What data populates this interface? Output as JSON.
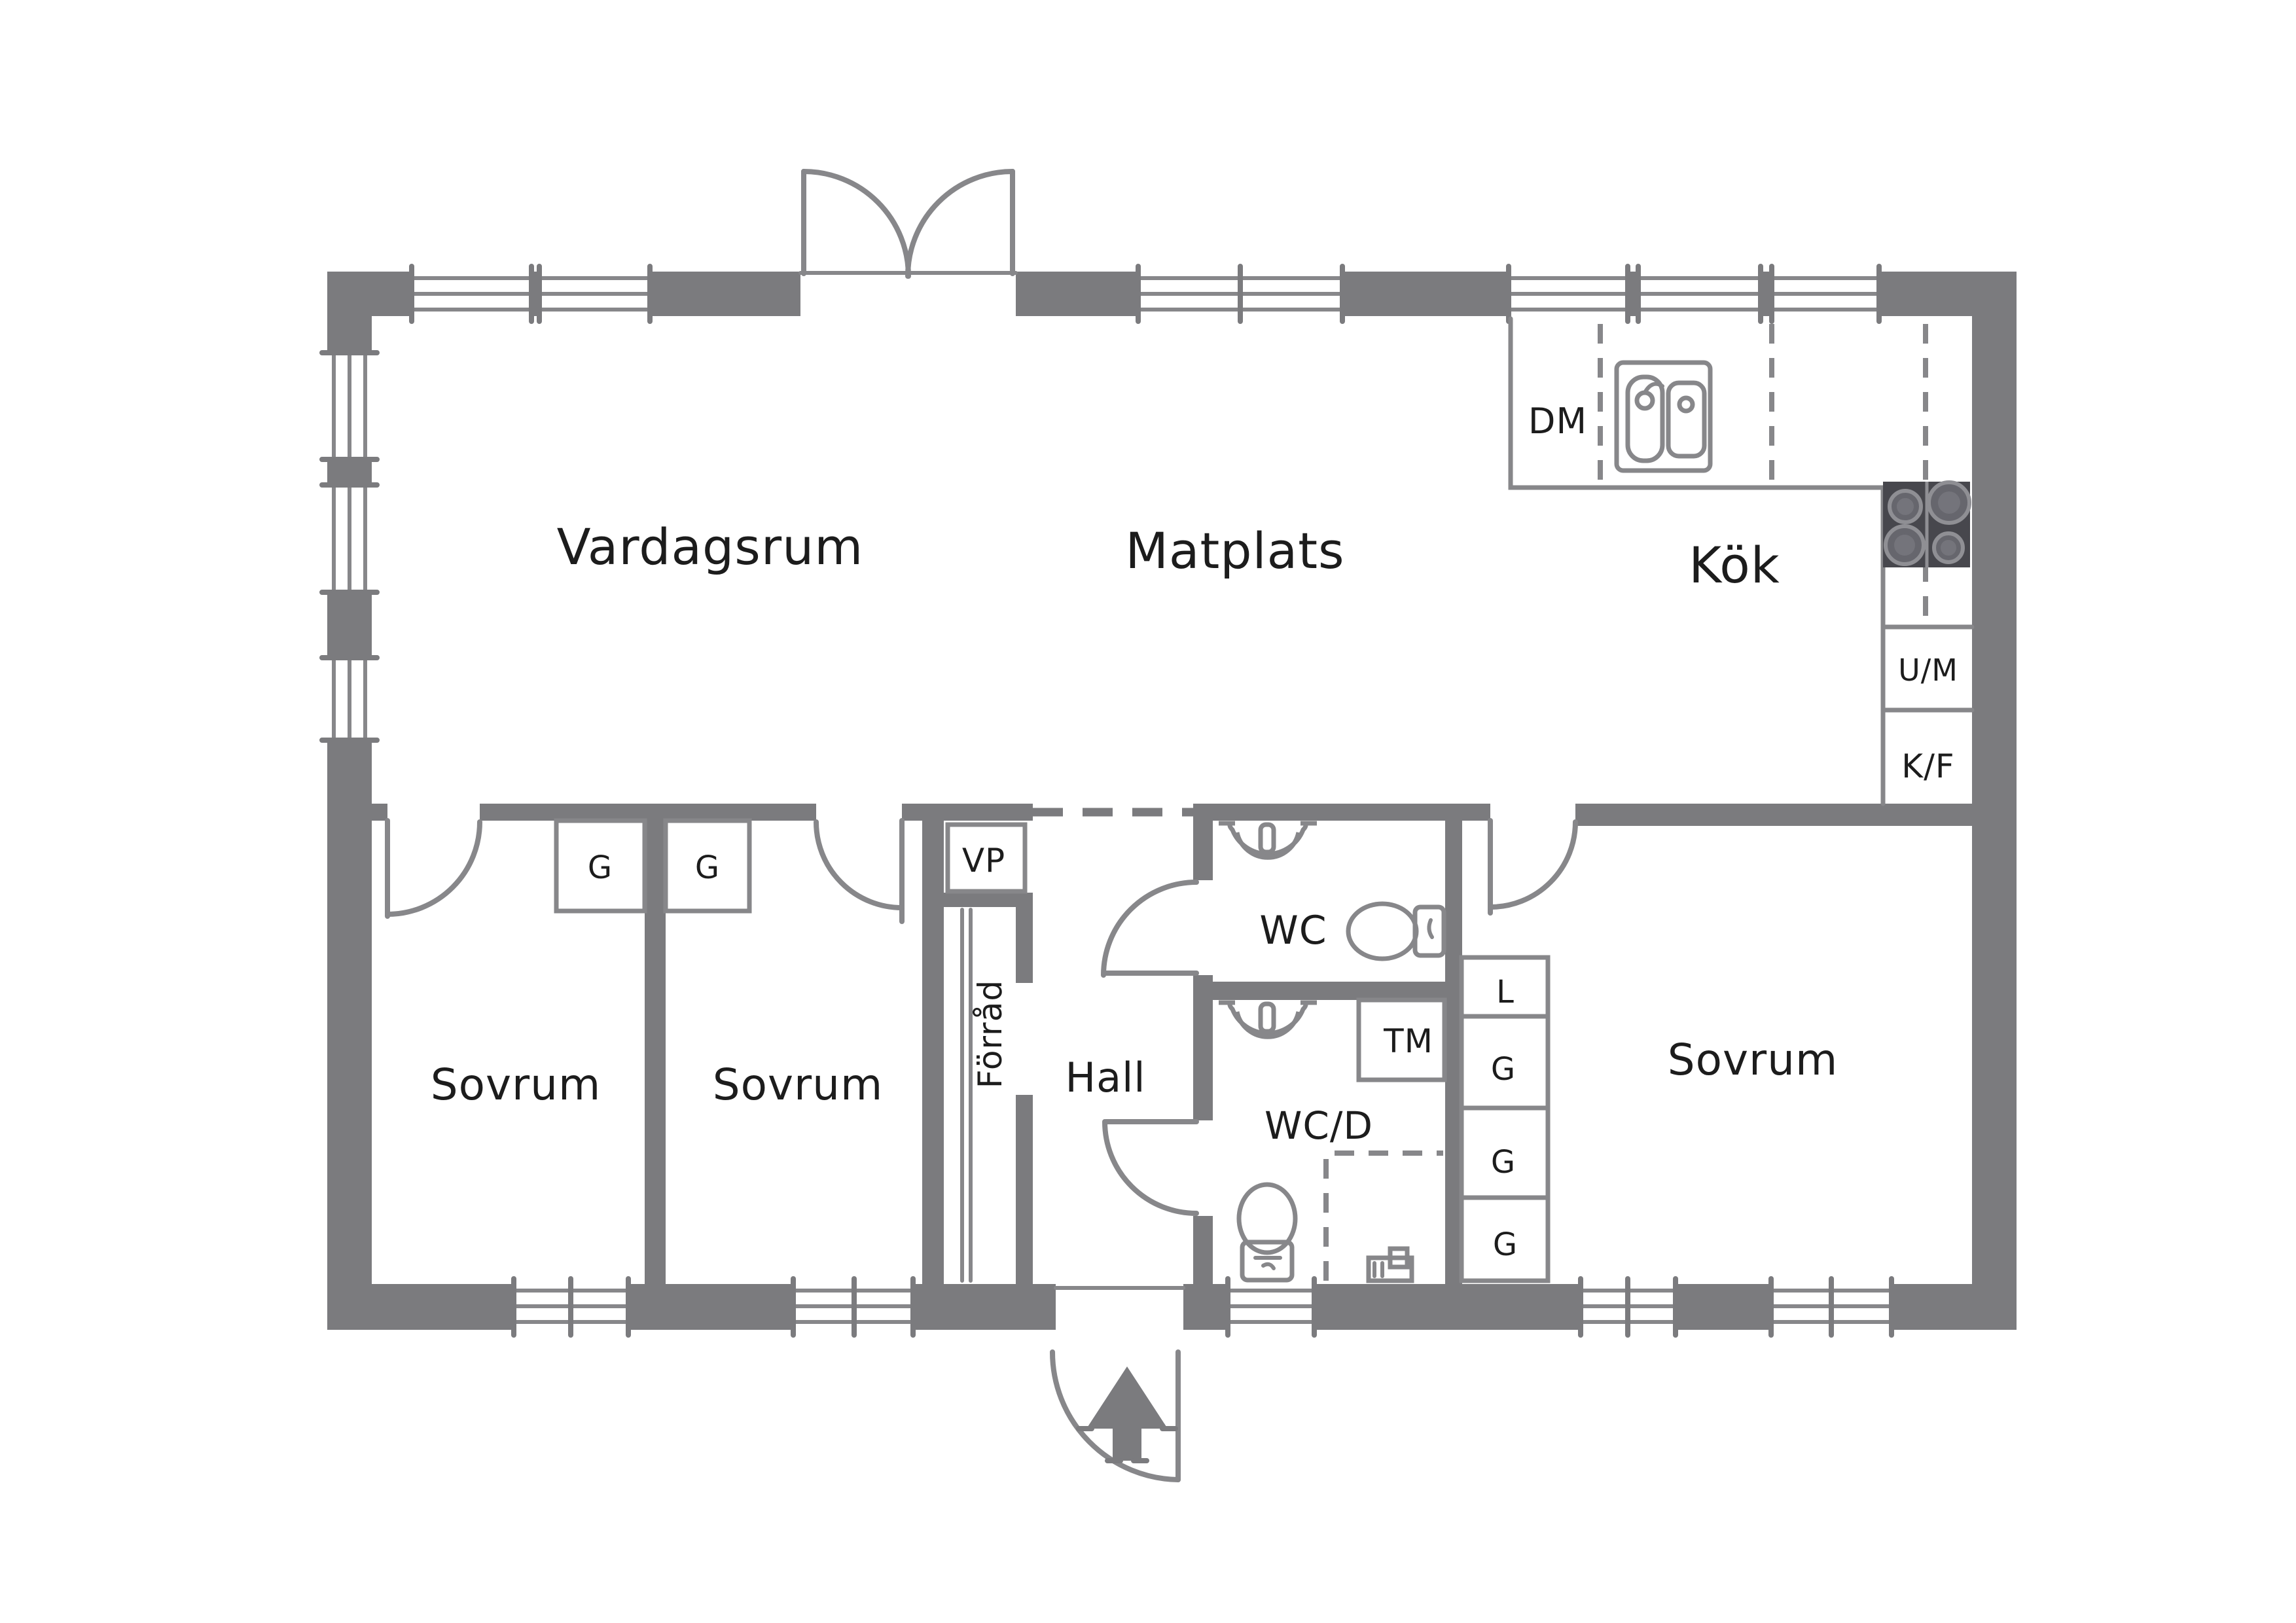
{
  "title": "Floor plan sketch (Swedish single-storey house)",
  "colors": {
    "wall_gray": "#7b7b7e",
    "line_gray": "#87878a",
    "stove_dark": "#47474d",
    "label_black": "#1c1c1c",
    "background": "#ffffff"
  },
  "rooms": {
    "living": "Vardagsrum",
    "dining": "Matplats",
    "kitchen": "Kök",
    "bedroom_left": "Sovrum",
    "bedroom_middle": "Sovrum",
    "bedroom_right": "Sovrum",
    "hall": "Hall",
    "storage_vertical": "Förråd",
    "wc": "WC",
    "wc_shower": "WC/D"
  },
  "appliances": {
    "dishwasher": "DM",
    "heat_pump": "VP",
    "washing_machine": "TM",
    "oven_microwave": "U/M",
    "fridge_freezer": "K/F"
  },
  "closets": {
    "linen": "L",
    "wardrobe_1": "G",
    "wardrobe_2": "G",
    "wardrobe_3": "G",
    "bedroom_wardrobe_1": "G",
    "bedroom_wardrobe_2": "G"
  },
  "icons": {
    "entry_arrow": "entry-direction-arrow",
    "double_door": "french-doors-symbol",
    "sink_double": "kitchen-double-sink",
    "stove": "stove-4-burners",
    "wc_sink": "hand-basin",
    "toilet": "toilet",
    "shower_zone": "dashed-shower-zone"
  }
}
